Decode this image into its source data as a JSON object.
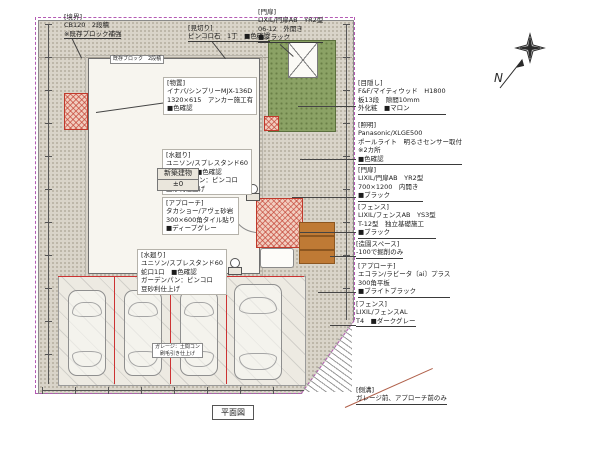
{
  "title": "平面図",
  "compass": {
    "n": "N"
  },
  "colors": {
    "boundary_line": "#b45ab4",
    "hatch_red": "#c0392b",
    "grass_green": "#8ba265",
    "soil_brown": "#bf7a35",
    "stipple_base": "#d9d4c9",
    "divider_red": "#cc3333"
  },
  "labels": {
    "boundary": {
      "lines": [
        "[境界]",
        "CB120　2段積",
        "※既存ブロック補強"
      ]
    },
    "mikiri": {
      "lines": [
        "[見切り]",
        "ピンコロ石　1丁　■色確認"
      ]
    },
    "gate_top": {
      "lines": [
        "[門扉]",
        "LIXIL/門扉AB　YR2型",
        "06-12　外開き",
        "■ブラック"
      ]
    },
    "mekakushi": {
      "lines": [
        "[目隠し]",
        "F&F/マイティウッド　H1800",
        "板13段　隙間10mm",
        "外化粧　■マロン"
      ]
    },
    "lighting": {
      "lines": [
        "[照明]",
        "Panasonic/XLGE500",
        "ポールライト　明るさセンサー取付",
        "※2カ所",
        "■色確認"
      ]
    },
    "gate_right": {
      "lines": [
        "[門扉]",
        "LIXIL/門扉AB　YR2型",
        "700×1200　内開き",
        "■ブラック"
      ]
    },
    "fence_ab": {
      "lines": [
        "[フェンス]",
        "LIXIL/フェンスAB　YS3型",
        "T-12型　独立基礎施工",
        "■ブラック"
      ]
    },
    "garden": {
      "lines": [
        "[造園スペース]",
        "-100で掘削のみ"
      ]
    },
    "approach_right": {
      "lines": [
        "[アプローチ]",
        "エコラン/ラビータ〔ai〕プラス",
        "300角平板",
        "■ブライトブラック"
      ]
    },
    "fence_al": {
      "lines": [
        "[フェンス]",
        "LIXIL/フェンスAL",
        "T4　■ダークグレー"
      ]
    },
    "shed": {
      "lines": [
        "[物置]",
        "イナバ/シンプリーMJX-136D",
        "1320×615　アンカー施工有",
        "■色確認"
      ]
    },
    "mizumawari1": {
      "lines": [
        "[水廻り]",
        "ユニソン/スプレスタンド60",
        "蛇口1口　■色確認",
        "ガーデンパン：ピンコロ",
        "豆砂利仕上げ"
      ]
    },
    "approach_main": {
      "lines": [
        "[アプローチ]",
        "タカショー/アヴェ砂岩",
        "300×600角タイル貼り",
        "■ディープグレー"
      ]
    },
    "mizumawari2": {
      "lines": [
        "[水廻り]",
        "ユニソン/スプレスタンド60",
        "蛇口1口　■色確認",
        "ガーデンパン：ピンコロ",
        "豆砂利仕上げ"
      ]
    },
    "gutter": {
      "lines": [
        "[側溝]",
        "ガレージ前、アプローチ前のみ"
      ]
    },
    "building_tag": {
      "lines": [
        "新築建物",
        "±0"
      ]
    },
    "garage_note": {
      "lines": [
        "ガレージ：土間コン",
        "刷毛引き仕上げ"
      ]
    },
    "strip_note": {
      "lines": [
        "既存ブロック　2段積"
      ]
    }
  }
}
